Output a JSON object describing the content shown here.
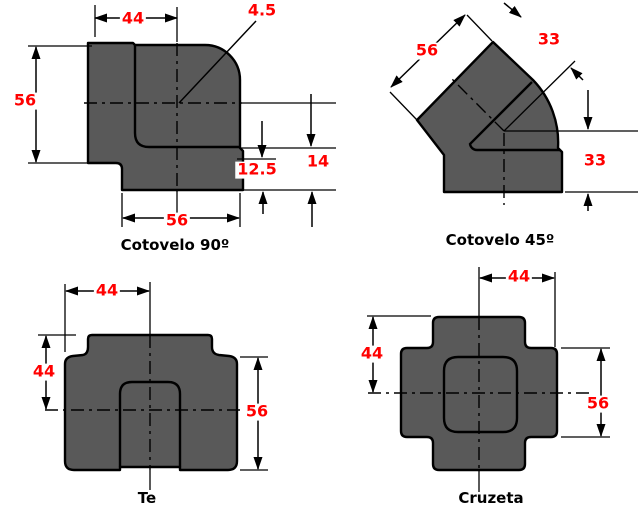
{
  "colors": {
    "body_fill": "#595959",
    "line": "#000000",
    "dimension_text": "#ff0000",
    "caption_text": "#000000",
    "background": "#ffffff"
  },
  "fittings": {
    "elbow90": {
      "caption": "Cotovelo 90º",
      "dim_top_width": "44",
      "dim_left_height": "56",
      "dim_bottom_width": "56",
      "dim_radius": "4.5",
      "dim_socket_depth": "12.5",
      "dim_end_distance": "14"
    },
    "elbow45": {
      "caption": "Cotovelo 45º",
      "dim_face_width": "56",
      "dim_center_to_top_face": "33",
      "dim_center_to_bottom_face": "33"
    },
    "tee": {
      "caption": "Te",
      "dim_top_width": "44",
      "dim_left_height": "44",
      "dim_right_height": "56"
    },
    "cross": {
      "caption": "Cruzeta",
      "dim_top_width": "44",
      "dim_left_height": "44",
      "dim_right_height": "56"
    }
  }
}
